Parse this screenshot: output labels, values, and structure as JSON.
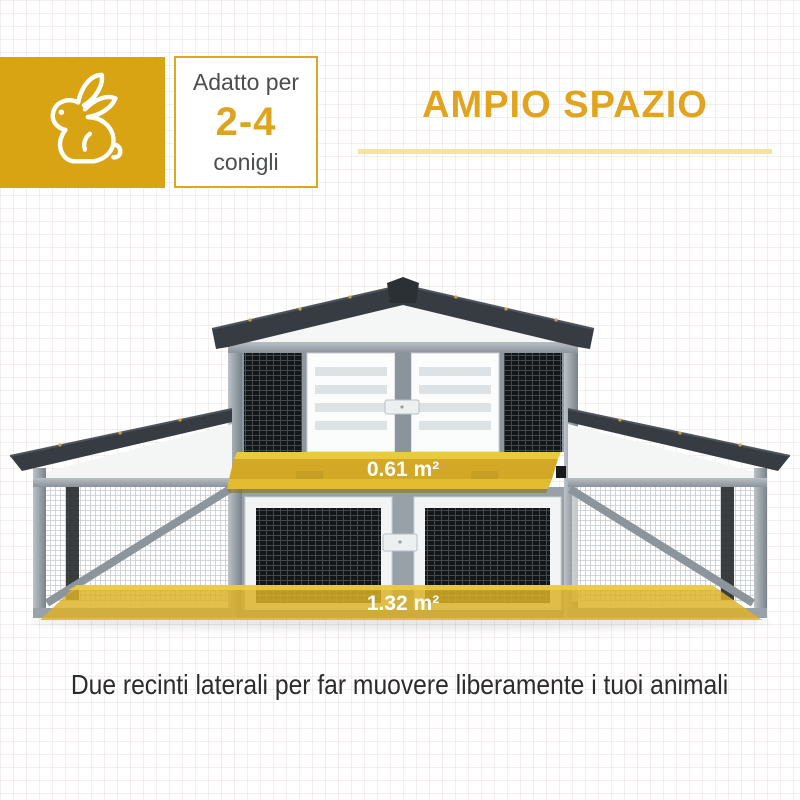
{
  "badge": {
    "icon": "rabbit-icon",
    "prefix": "Adatto per",
    "count": "2-4",
    "animal": "conigli"
  },
  "heading": {
    "title": "AMPIO SPAZIO"
  },
  "hutch": {
    "upper_area": "0.61 m²",
    "lower_area": "1.32 m²"
  },
  "caption": {
    "text": "Due recinti laterali per far muovere liberamente i tuoi animali"
  },
  "colors": {
    "badge_gold": "#d8a414",
    "accent_gold": "#e2a41f",
    "underline_gold": "#f6e2a2",
    "highlight_yellow": "#d3a826",
    "floor_yellow": "#dcb127",
    "roof_dark": "#363c42",
    "frame_gray": "#99a1a8",
    "caption_dark": "#2c2c2c",
    "area_label_white": "#ffffff"
  }
}
